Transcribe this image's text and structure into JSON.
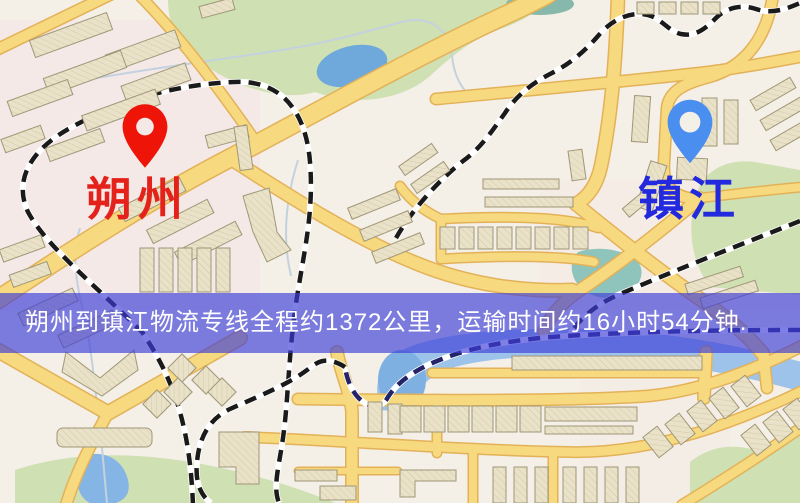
{
  "banner": {
    "text": "朔州到镇江物流专线全程约1372公里，运输时间约16小时54分钟.",
    "background_color": "#3c3cd7",
    "text_color": "#ffffff"
  },
  "markers": {
    "origin": {
      "label": "朔州",
      "label_color": "#e4211a",
      "pin_color": "#ee1408"
    },
    "destination": {
      "label": "镇江",
      "label_color": "#2329dd",
      "pin_color": "#4a8ef0"
    }
  },
  "map": {
    "colors": {
      "background": "#f4efe7",
      "road_fill": "#f7d97f",
      "road_casing": "#e3b258",
      "park": "#cfe0b2",
      "water": "#9ec3ea",
      "lake": "#6fa9dc",
      "building": "#e9e2c8",
      "railway": "#1a1a1a"
    }
  }
}
